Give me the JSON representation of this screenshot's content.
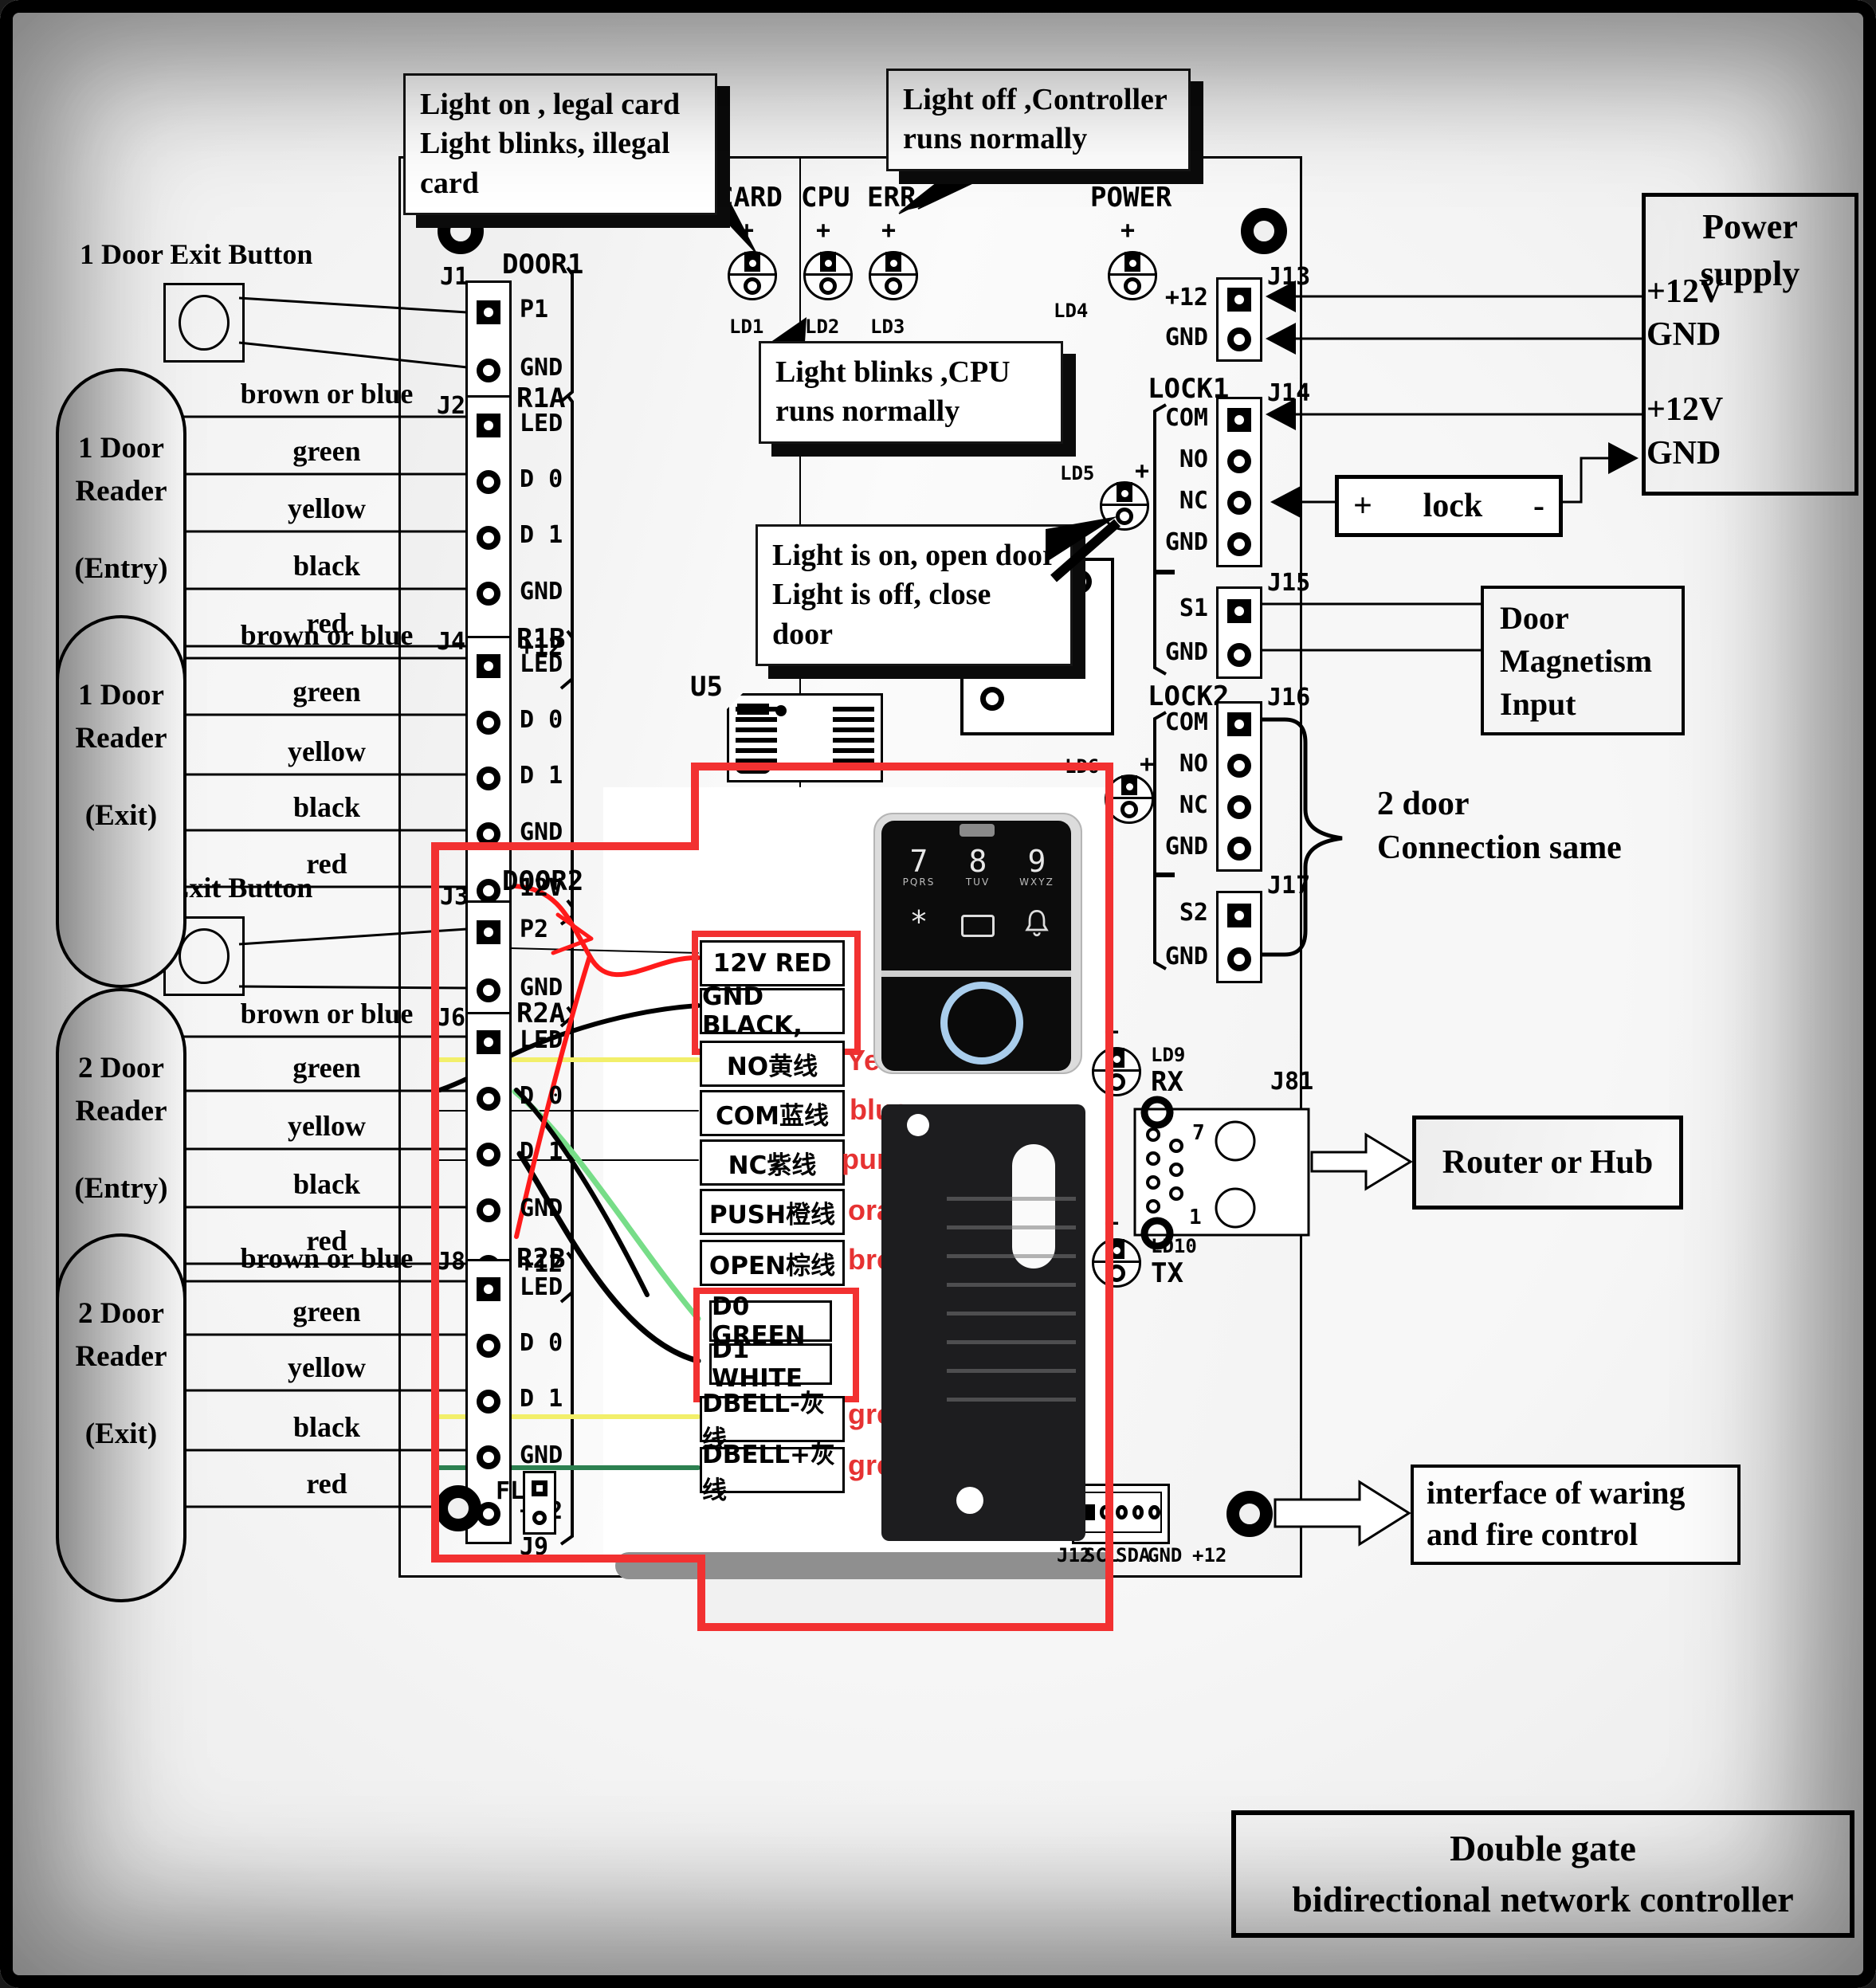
{
  "callouts": {
    "card_status": {
      "line1": "Light on , legal card",
      "line2": "Light blinks, illegal",
      "line3": "card"
    },
    "err_status": {
      "line1": "Light off ,Controller",
      "line2": "runs normally"
    },
    "cpu_status": {
      "line1": "Light blinks ,CPU",
      "line2": "runs normally"
    },
    "lock_led_status": {
      "line1": "Light is on, open door",
      "line2": "Light is off, close door"
    }
  },
  "leds": {
    "plus": "+",
    "card": {
      "label": "CARD",
      "ref": "LD1"
    },
    "cpu": {
      "label": "CPU",
      "ref": "LD2"
    },
    "err": {
      "label": "ERR",
      "ref": "LD3"
    },
    "power": {
      "label": "POWER",
      "ref": "LD4"
    },
    "lock1": {
      "ref": "LD5"
    },
    "lock2": {
      "ref": "LD6"
    },
    "rx": {
      "ref": "LD9",
      "label": "RX"
    },
    "tx": {
      "ref": "LD10",
      "label": "TX"
    }
  },
  "connectors": {
    "j1": {
      "ref": "J1",
      "name": "DOOR1",
      "pins": [
        "P1",
        "GND"
      ]
    },
    "j2": {
      "ref": "J2",
      "name": "R1A",
      "pins": [
        "LED",
        "D 0",
        "D 1",
        "GND",
        "+12"
      ]
    },
    "j4": {
      "ref": "J4",
      "name": "R1B",
      "pins": [
        "LED",
        "D 0",
        "D 1",
        "GND",
        "12V"
      ]
    },
    "j3": {
      "ref": "J3",
      "name": "DOOR2",
      "pins": [
        "P2",
        "GND"
      ]
    },
    "j6": {
      "ref": "J6",
      "name": "R2A",
      "pins": [
        "LED",
        "D 0",
        "D 1",
        "GND",
        "+12"
      ]
    },
    "j8": {
      "ref": "J8",
      "name": "R2B",
      "pins": [
        "LED",
        "D 0",
        "D 1",
        "GND",
        "+12"
      ]
    },
    "j9": {
      "ref": "J9",
      "name": "FL"
    },
    "j13": {
      "ref": "J13",
      "pins": [
        "+12",
        "GND"
      ]
    },
    "j14": {
      "ref": "J14",
      "group": "LOCK1",
      "pins": [
        "COM",
        "NO",
        "NC",
        "GND"
      ]
    },
    "j15": {
      "ref": "J15",
      "pins": [
        "S1",
        "GND"
      ]
    },
    "j16": {
      "ref": "J16",
      "group": "LOCK2",
      "pins": [
        "COM",
        "NO",
        "NC",
        "GND"
      ]
    },
    "j17": {
      "ref": "J17",
      "pins": [
        "S2",
        "GND"
      ]
    },
    "j81": {
      "ref": "J81",
      "pin7": "7",
      "pin1": "1"
    },
    "j12": {
      "ref": "J12",
      "pins": [
        "SCL",
        "SDA",
        "GND",
        "+12"
      ]
    },
    "u5": {
      "ref": "U5"
    }
  },
  "field_devices": {
    "exit_button_1": "1 Door Exit Button",
    "exit_button_2": "2 Door Exit Button",
    "reader_1_entry": {
      "line1": "1 Door",
      "line2": "Reader",
      "line3": "(Entry)"
    },
    "reader_1_exit": {
      "line1": "1 Door",
      "line2": "Reader",
      "line3": "(Exit)"
    },
    "reader_2_entry": {
      "line1": "2 Door",
      "line2": "Reader",
      "line3": "(Entry)"
    },
    "reader_2_exit": {
      "line1": "2 Door",
      "line2": "Reader",
      "line3": "(Exit)"
    },
    "reader_wire_colors": [
      "brown or blue",
      "green",
      "yellow",
      "black",
      "red"
    ]
  },
  "info_boxes": {
    "power_supply": {
      "title_line1": "Power",
      "title_line2": "supply",
      "rows": [
        "+12V",
        "GND",
        "+12V",
        "GND"
      ]
    },
    "lock": {
      "plus": "+",
      "label": "lock",
      "minus": "-"
    },
    "door_magnetism": {
      "line1": "Door",
      "line2": "Magnetism",
      "line3": "Input"
    },
    "two_door": {
      "line1": "2 door",
      "line2": "Connection same"
    },
    "router": "Router or Hub",
    "fire_interface": {
      "line1": "interface of waring",
      "line2": "and fire control"
    },
    "title": {
      "line1": "Double gate",
      "line2": "bidirectional network controller"
    }
  },
  "wiring_table": {
    "rows": [
      "12V RED",
      "GND BLACK,",
      "NO黄线",
      "COM蓝线",
      "NC紫线",
      "PUSH橙线",
      "OPEN棕线",
      "D0 GREEN",
      "D1 WHITE",
      "DBELL-灰线",
      "DBELL+灰线"
    ],
    "annotations": [
      "Yellwow",
      "blue",
      "purple",
      "orange",
      "brown",
      "grey",
      "grey"
    ]
  },
  "keypad": {
    "keys": [
      {
        "digit": "7",
        "letters": "PQRS"
      },
      {
        "digit": "8",
        "letters": "TUV"
      },
      {
        "digit": "9",
        "letters": "WXYZ"
      }
    ],
    "star": "*"
  },
  "colors": {
    "red_box": "#f23131",
    "annotation_red": "#e63232",
    "wire_red": "#ff1a1a",
    "wire_light_green": "#77dd88",
    "wire_yellow": "#f2ef6a",
    "wire_dark_green": "#2c8050",
    "fingerprint_ring": "#a9cdec"
  }
}
